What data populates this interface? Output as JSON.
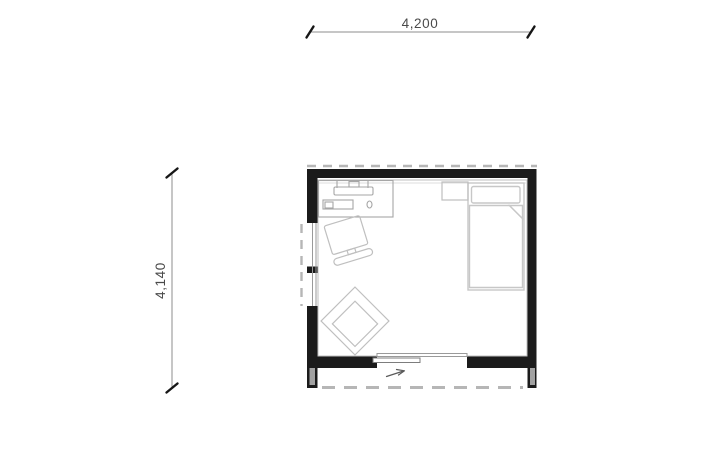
{
  "dimensions": {
    "top": {
      "label": "4,200"
    },
    "left": {
      "label": "4,140"
    }
  },
  "plan": {
    "furniture": [
      "desk",
      "monitor",
      "keyboard",
      "mouse",
      "desk-chair",
      "armchair",
      "bed",
      "pillow",
      "blanket",
      "nightstand"
    ],
    "features": [
      "left-window",
      "sliding-door",
      "porch-deck",
      "roof-overhang-dashed",
      "door-direction-arrow"
    ]
  },
  "colors": {
    "bg": "#ffffff",
    "wall": "#1b1b1b",
    "lining": "#bfbfbf",
    "lining2": "#dcdcdc",
    "glazing": "#9a9a9a",
    "dashed": "#b6b6b6",
    "pier-fill": "#a2a2a2",
    "furniture": "#bfbfbf",
    "desk-line": "#a6a6a6",
    "bed-line": "#c7c7c7",
    "panel-line": "#7d7d7d",
    "arrow": "#5a5a5a",
    "dim-line": "#8c8c8c",
    "dim-text": "#4a4a4a",
    "tick": "#161616"
  }
}
